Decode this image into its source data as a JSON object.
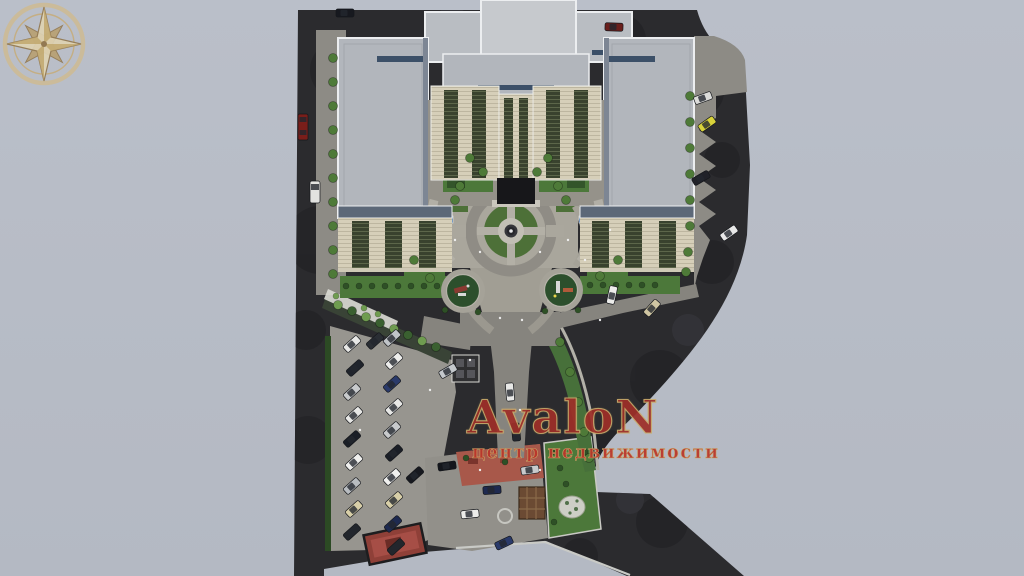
{
  "watermark": {
    "brand": "AvaloN",
    "tagline": "центр недвижимости",
    "icon": "compass-rose-icon"
  },
  "colors": {
    "background": "#b7bcc6",
    "site-dark": "#2b2b2e",
    "roof-gray": "#b2b6bc",
    "roof-light": "#c6c9cd",
    "roof-accent-blue": "#3c5068",
    "facade-cream": "#d8d1bc",
    "window-strip-green": "#39422e",
    "road-gray": "#8d8b85",
    "plaza-path": "#a9a69c",
    "lawn-green": "#4c783a",
    "hedge-green": "#2c4a24",
    "red-paving": "#a8584a",
    "brand-red": "#9e2f28",
    "tagline-red": "#bb352a",
    "compass-gold": "#c9a96a"
  }
}
